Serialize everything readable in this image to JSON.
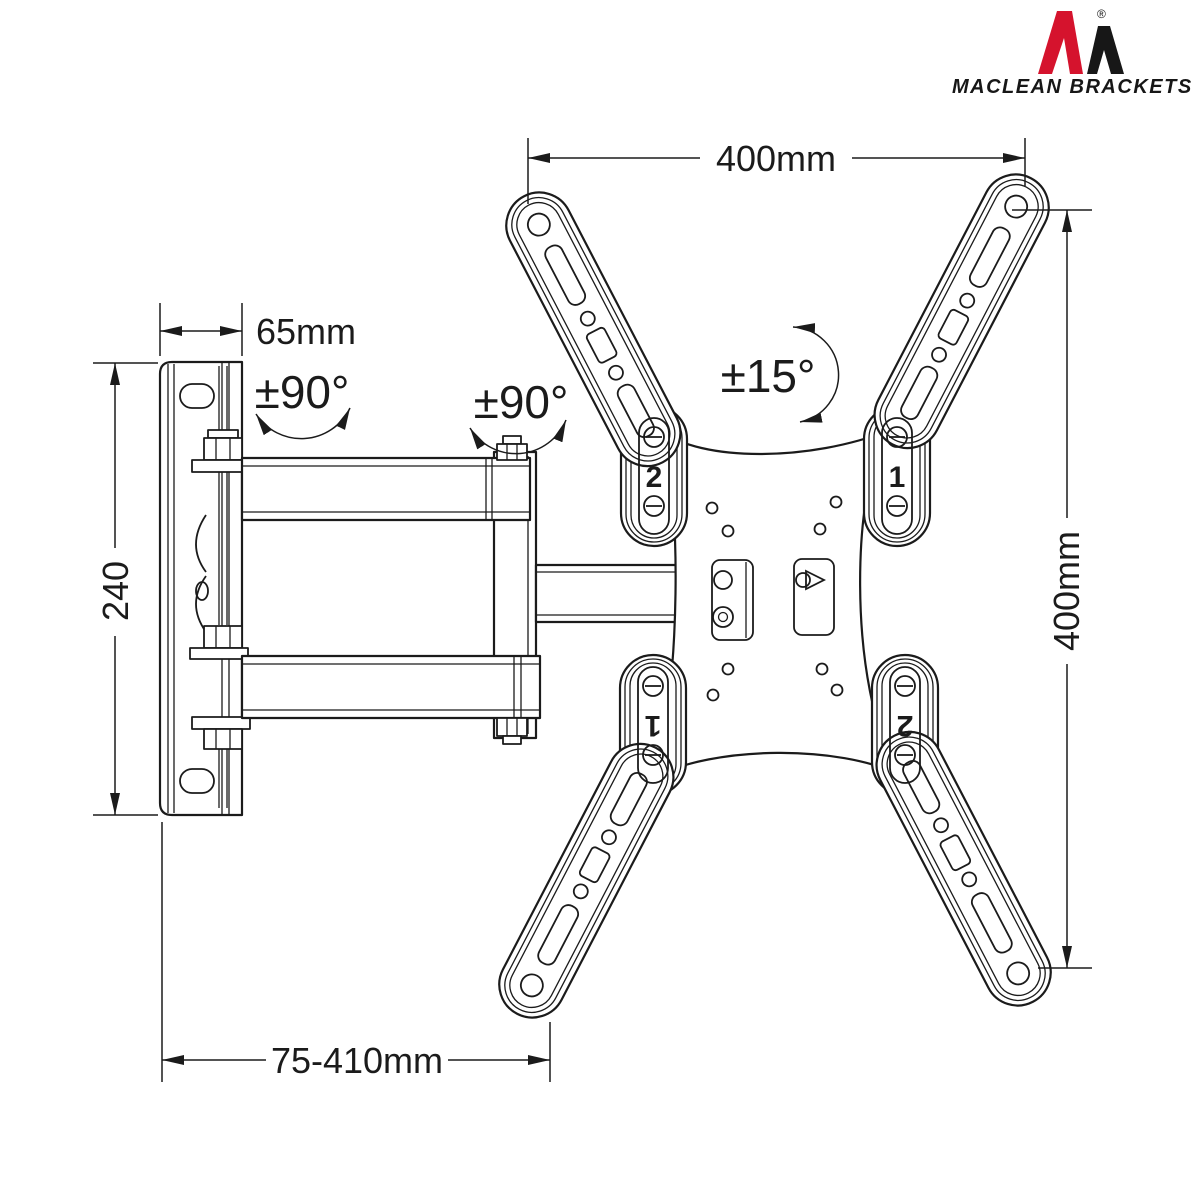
{
  "page": {
    "background": "#ffffff",
    "line_color": "#1b1b1b"
  },
  "logo": {
    "brand": "MACLEAN BRACKETS",
    "registered_mark": "®",
    "red": "#d5132d",
    "black": "#171717"
  },
  "dimensions": {
    "vesa_width": "400mm",
    "vesa_height": "400mm",
    "wall_plate_depth": "65mm",
    "wall_plate_height": "240",
    "extension_range": "75-410mm"
  },
  "angles": {
    "swivel_wall": "±90°",
    "swivel_arm": "±90°",
    "tilt": "±15°"
  },
  "arm_labels": {
    "top_left": "2",
    "top_right": "1",
    "bottom_left": "1",
    "bottom_right": "2"
  }
}
